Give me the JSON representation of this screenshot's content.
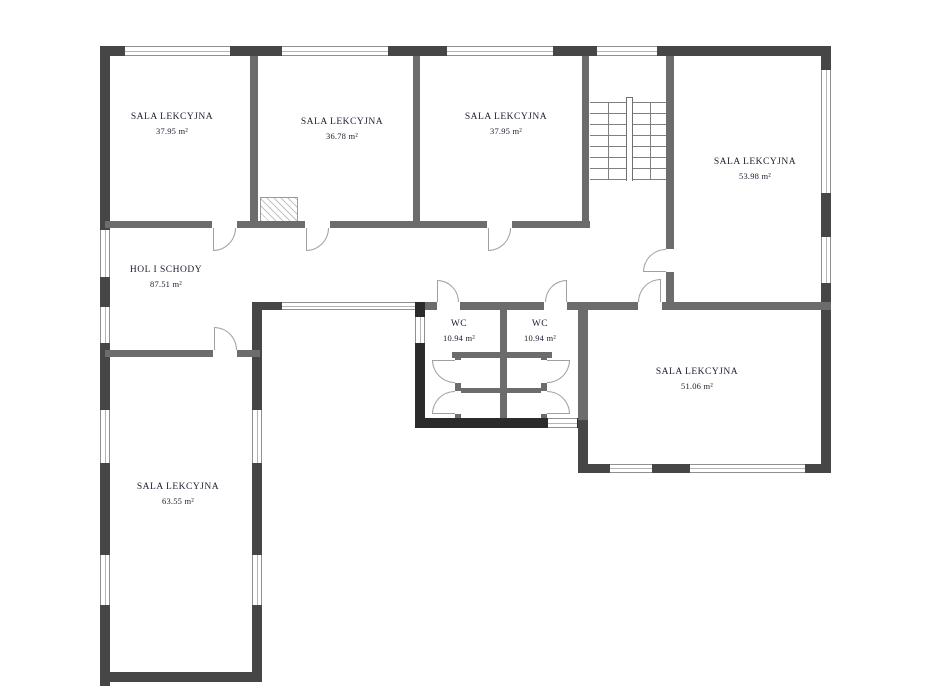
{
  "plan_title": "school floor plan",
  "colors": {
    "exterior_wall": "#464646",
    "dark_wall": "#2b2b2b",
    "interior_wall": "#6c6c6c",
    "window_frame": "#909090",
    "door_arc": "#a0a0a0",
    "label_text": "#1c1c2e",
    "background": "#ffffff"
  },
  "rooms": [
    {
      "id": "classroom-top-left",
      "name": "SALA LEKCYJNA",
      "area": "37.95 m²"
    },
    {
      "id": "classroom-top-middle",
      "name": "SALA LEKCYJNA",
      "area": "36.78 m²"
    },
    {
      "id": "classroom-top-right",
      "name": "SALA LEKCYJNA",
      "area": "37.95 m²"
    },
    {
      "id": "classroom-right",
      "name": "SALA LEKCYJNA",
      "area": "53.98 m²"
    },
    {
      "id": "hall-and-stairs",
      "name": "HOL I SCHODY",
      "area": "87.51 m²"
    },
    {
      "id": "wc-left",
      "name": "WC",
      "area": "10.94 m²"
    },
    {
      "id": "wc-right",
      "name": "WC",
      "area": "10.94 m²"
    },
    {
      "id": "classroom-bottom-right",
      "name": "SALA LEKCYJNA",
      "area": "51.06 m²"
    },
    {
      "id": "classroom-bottom-left",
      "name": "SALA LEKCYJNA",
      "area": "63.55 m²"
    }
  ]
}
